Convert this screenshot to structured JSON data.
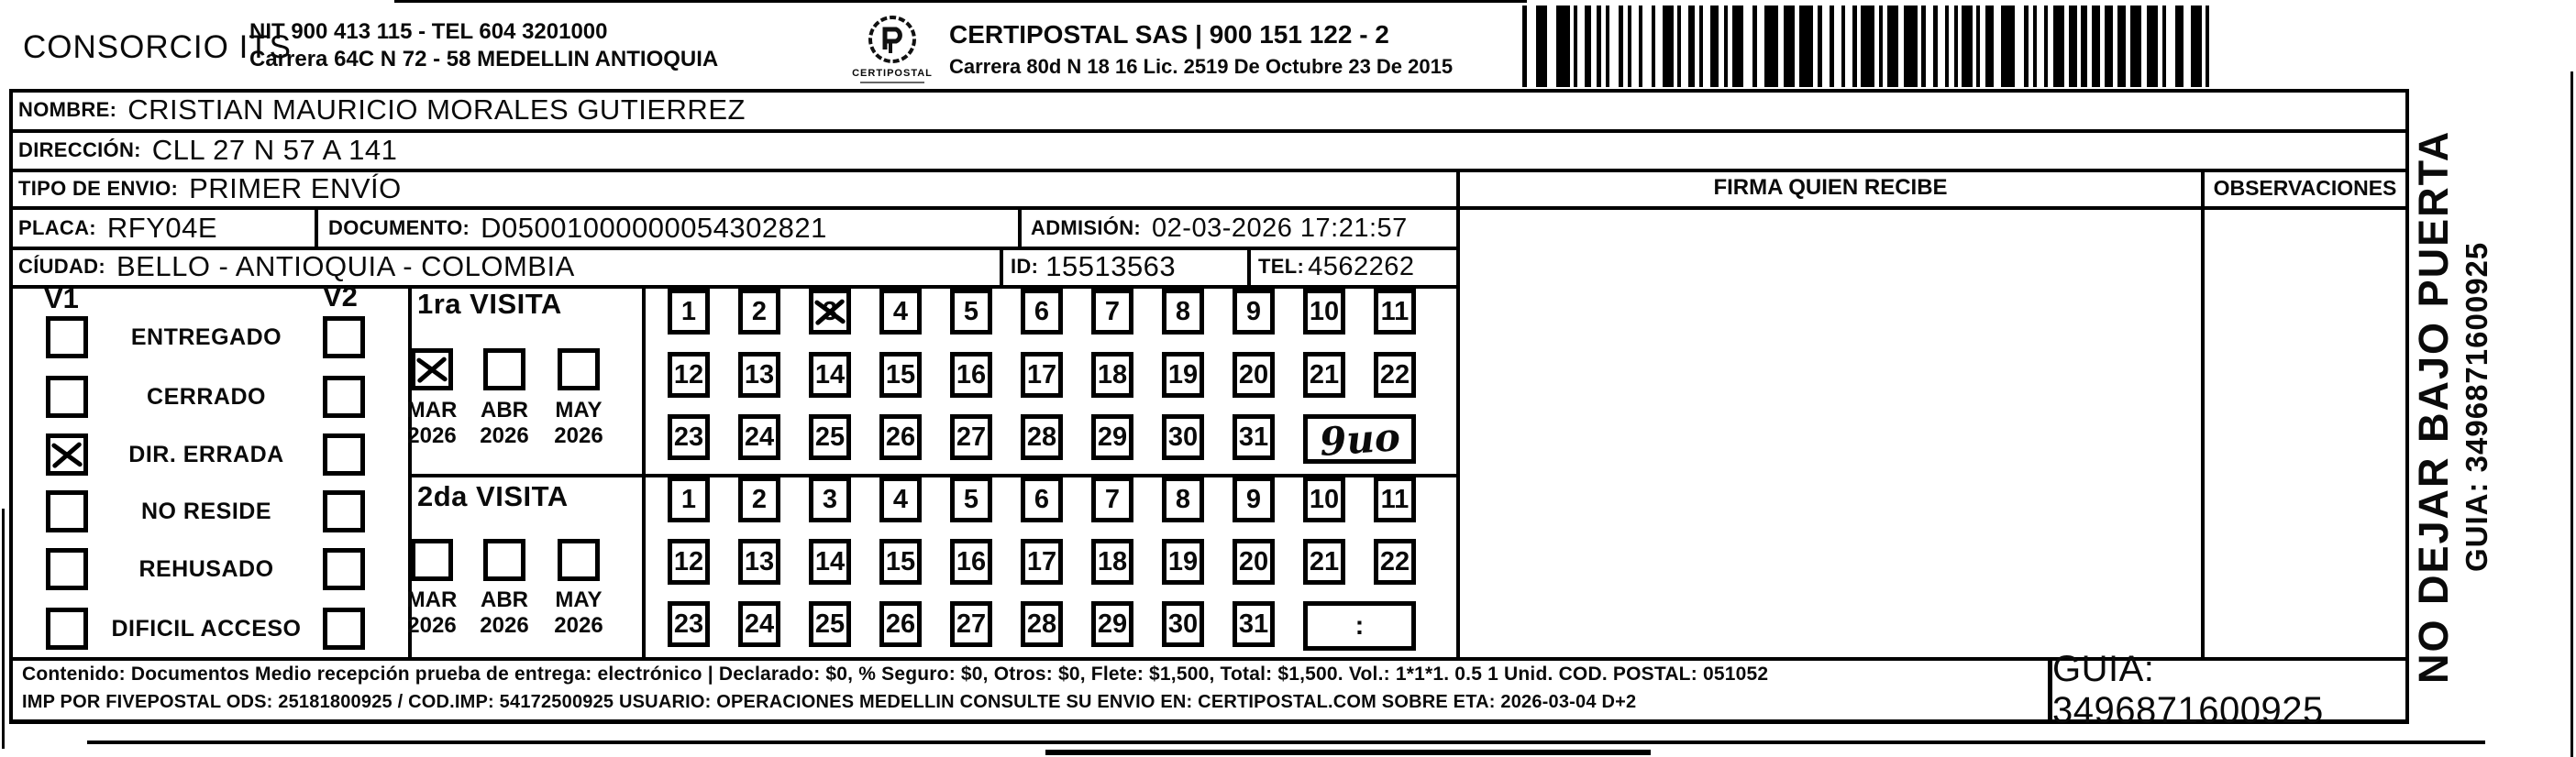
{
  "header": {
    "company": "CONSORCIO ITS",
    "company_info_line1": "NIT 900 413 115 - TEL 604 3201000",
    "company_info_line2": "Carrera 64C N 72 - 58 MEDELLIN ANTIOQUIA",
    "logo_text": "CERTIPOSTAL",
    "courier_line1": "CERTIPOSTAL SAS | 900 151 122 - 2",
    "courier_line2": "Carrera 80d N 18 16  Lic. 2519 De Octubre 23 De 2015"
  },
  "shipment": {
    "nombre_label": "NOMBRE:",
    "nombre": "CRISTIAN MAURICIO MORALES GUTIERREZ",
    "direccion_label": "DIRECCIÓN:",
    "direccion": "CLL 27 N 57 A 141",
    "tipo_envio_label": "TIPO DE ENVIO:",
    "tipo_envio": "PRIMER ENVÍO",
    "placa_label": "PLACA:",
    "placa": "RFY04E",
    "documento_label": "DOCUMENTO:",
    "documento": "D05001000000054302821",
    "admision_label": "ADMISIÓN:",
    "admision": "02-03-2026 17:21:57",
    "ciudad_label": "CÍUDAD:",
    "ciudad": "BELLO - ANTIOQUIA - COLOMBIA",
    "id_label": "ID:",
    "id": "15513563",
    "tel_label": "TEL:",
    "tel": "4562262"
  },
  "signature": {
    "firma_header": "FIRMA QUIEN RECIBE",
    "observaciones_header": "OBSERVACIONES"
  },
  "status": {
    "v1_label": "V1",
    "v2_label": "V2",
    "options": [
      {
        "label": "ENTREGADO",
        "v1_checked": false,
        "v2_checked": false
      },
      {
        "label": "CERRADO",
        "v1_checked": false,
        "v2_checked": false
      },
      {
        "label": "DIR. ERRADA",
        "v1_checked": true,
        "v2_checked": false
      },
      {
        "label": "NO RESIDE",
        "v1_checked": false,
        "v2_checked": false
      },
      {
        "label": "REHUSADO",
        "v1_checked": false,
        "v2_checked": false
      },
      {
        "label": "DIFICIL ACCESO",
        "v1_checked": false,
        "v2_checked": false
      }
    ]
  },
  "visits": {
    "first": {
      "title": "1ra VISITA",
      "months": [
        {
          "label": "MAR",
          "year": "2026",
          "checked": true
        },
        {
          "label": "ABR",
          "year": "2026",
          "checked": false
        },
        {
          "label": "MAY",
          "year": "2026",
          "checked": false
        }
      ],
      "day_rows": [
        [
          1,
          2,
          3,
          4,
          5,
          6,
          7,
          8,
          9,
          10,
          11
        ],
        [
          12,
          13,
          14,
          15,
          16,
          17,
          18,
          19,
          20,
          21,
          22
        ],
        [
          23,
          24,
          25,
          26,
          27,
          28,
          29,
          30,
          31
        ]
      ],
      "checked_day": 3,
      "handwritten_time": "9uo"
    },
    "second": {
      "title": "2da VISITA",
      "months": [
        {
          "label": "MAR",
          "year": "2026",
          "checked": false
        },
        {
          "label": "ABR",
          "year": "2026",
          "checked": false
        },
        {
          "label": "MAY",
          "year": "2026",
          "checked": false
        }
      ],
      "day_rows": [
        [
          1,
          2,
          3,
          4,
          5,
          6,
          7,
          8,
          9,
          10,
          11
        ],
        [
          12,
          13,
          14,
          15,
          16,
          17,
          18,
          19,
          20,
          21,
          22
        ],
        [
          23,
          24,
          25,
          26,
          27,
          28,
          29,
          30,
          31
        ]
      ],
      "checked_day": null,
      "time_placeholder": ":"
    }
  },
  "side": {
    "warning": "NO DEJAR BAJO PUERTA",
    "guia_vertical": "GUIA: 3496871600925"
  },
  "footer": {
    "line1": "Contenido: Documentos Medio recepción prueba de entrega: electrónico | Declarado: $0, % Seguro: $0, Otros: $0, Flete: $1,500, Total: $1,500. Vol.: 1*1*1. 0.5  1 Unid. COD. POSTAL: 051052",
    "line2": "IMP POR FIVEPOSTAL ODS: 25181800925 / COD.IMP: 54172500925 USUARIO: OPERACIONES MEDELLIN CONSULTE SU ENVIO EN: CERTIPOSTAL.COM SOBRE ETA: 2026-03-04 D+2",
    "guia_box": "GUIA: 3496871600925"
  }
}
